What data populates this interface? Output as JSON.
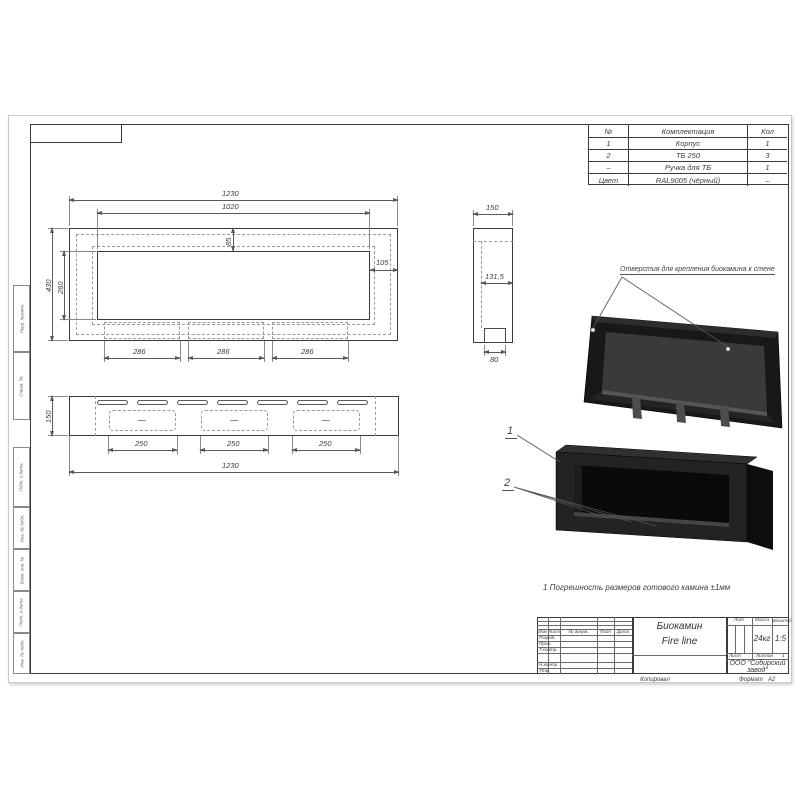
{
  "table": {
    "headers": [
      "№",
      "Комплектация",
      "Кол"
    ],
    "rows": [
      [
        "1",
        "Корпус",
        "1"
      ],
      [
        "2",
        "ТБ 250",
        "3"
      ],
      [
        "–",
        "Ручка для ТБ",
        "1"
      ],
      [
        "Цвет",
        "RAL9005 (чёрный)",
        "–"
      ]
    ]
  },
  "views": {
    "front": {
      "dims": {
        "w1": "1230",
        "w2": "1020",
        "h1": "430",
        "h2": "260",
        "top": "85",
        "side": "105",
        "sp": [
          "286",
          "286",
          "286"
        ]
      }
    },
    "side": {
      "dims": {
        "w": "150",
        "inner": "131,5",
        "bottom": "80"
      }
    },
    "bottom": {
      "dims": {
        "h": "150",
        "w": "1230",
        "sp": [
          "250",
          "250",
          "250"
        ]
      }
    }
  },
  "annotations": {
    "holes": "Отверстия для крепления биокамина к стене",
    "callout_1": "1",
    "callout_2": "2",
    "note": "1 Погрешность размеров готового камина ±1мм"
  },
  "title_block": {
    "title_line1": "Биокамин",
    "title_line2": "Fire line",
    "col_izm": "Изм",
    "col_list": "Лист",
    "col_doc": "№ докум.",
    "col_podp": "Подп",
    "col_data": "Дата",
    "row_razrab": "Разраб.",
    "row_prov": "Пров.",
    "row_tkontr": "Т.контр.",
    "row_nkontr": "Н.контр.",
    "row_utv": "Утв.",
    "lit_label": "Лит.",
    "mass_label": "Масса",
    "scale_label": "Масштаб",
    "mass_value": "24кг",
    "scale_value": "1:5",
    "sheet_label": "Лист",
    "sheets_label": "Листов",
    "sheets_value": "1",
    "company_line1": "ООО \"Сибирский",
    "company_line2": "завод\"",
    "copied": "Копировал",
    "format_label": "Формат",
    "format_value": "А2"
  },
  "margin_stamps": [
    "Перв. примен.",
    "Справ. №",
    "Подп. и дата",
    "Инв. № дубл.",
    "Взам. инв. №",
    "Подп. и дата",
    "Инв. № подл."
  ],
  "colors": {
    "line": "#3a3a3a",
    "dim": "#5a5a5a",
    "fire_black": "#1b1b1b",
    "panel_gray": "#3a3a3a"
  }
}
